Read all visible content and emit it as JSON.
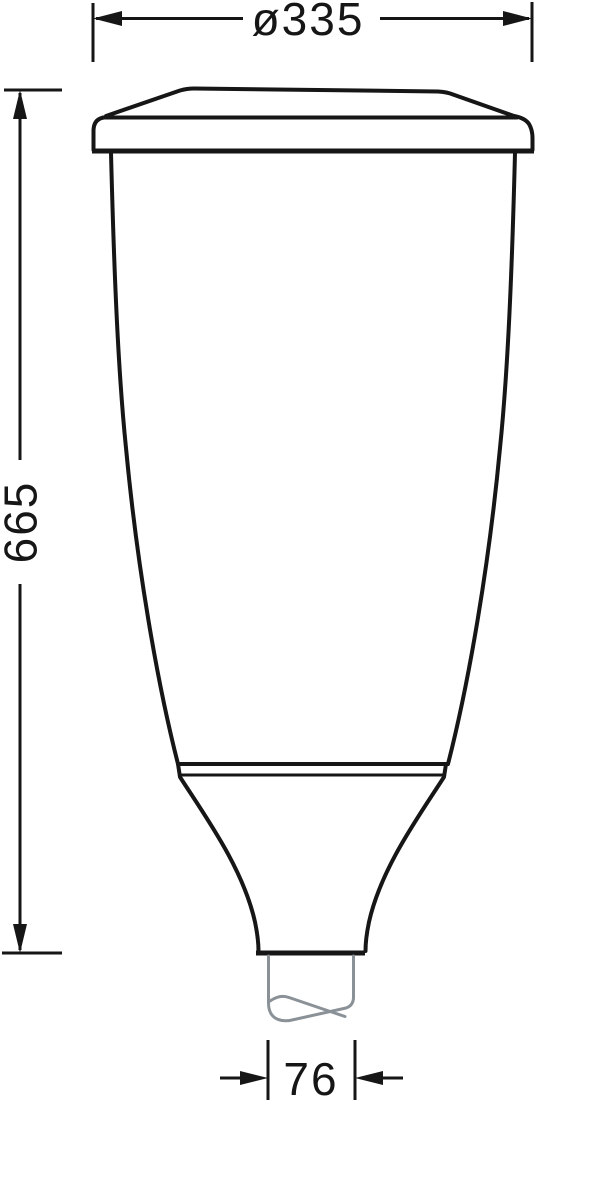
{
  "colors": {
    "outline": "#161616",
    "pole": "#8a9197",
    "background": "#ffffff"
  },
  "dimensions": {
    "diameter": {
      "label": "ø335"
    },
    "height": {
      "label": "665"
    },
    "spigot": {
      "label": "76"
    }
  }
}
